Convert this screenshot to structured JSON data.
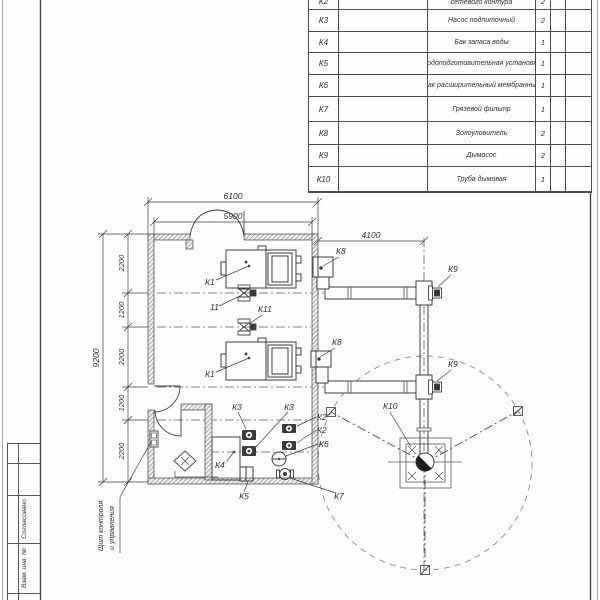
{
  "spec": {
    "rows": [
      {
        "pos": "К2",
        "name": "сетевого контура",
        "qty": "2"
      },
      {
        "pos": "К3",
        "name": "Насос подпиточный",
        "qty": "2"
      },
      {
        "pos": "К4",
        "name": "Бак запаса воды",
        "qty": "1"
      },
      {
        "pos": "К5",
        "name": "Водоподготовительная установка",
        "qty": "1"
      },
      {
        "pos": "К6",
        "name": "Бак расширительный мембранный",
        "qty": "1"
      },
      {
        "pos": "К7",
        "name": "Грязевой фильтр",
        "qty": "1"
      },
      {
        "pos": "К8",
        "name": "Золоуловитель",
        "qty": "2"
      },
      {
        "pos": "К9",
        "name": "Дымосос",
        "qty": "2"
      },
      {
        "pos": "К10",
        "name": "Труба дымовая",
        "qty": "1"
      }
    ]
  },
  "plan": {
    "labels": {
      "k1": "К1",
      "k2": "К2",
      "k3": "К3",
      "k4": "К4",
      "k5": "К5",
      "k6": "К6",
      "k7": "К7",
      "k8": "К8",
      "k9": "К9",
      "k10": "К10",
      "k11": "К11",
      "v11": "11"
    },
    "dims": {
      "w_out": "6100",
      "w_in": "5900",
      "duct": "4100",
      "h_out": "9200",
      "segs": [
        "2200",
        "1200",
        "2200",
        "1200",
        "2200"
      ]
    },
    "annotations": {
      "panel1": "Щит контроля",
      "panel2": "и управления"
    }
  },
  "title_block": {
    "approved": "Согласовано",
    "inv": "Взам. инв. №"
  },
  "colors": {
    "line": "#3f3f3f",
    "hatch": "#777777"
  }
}
